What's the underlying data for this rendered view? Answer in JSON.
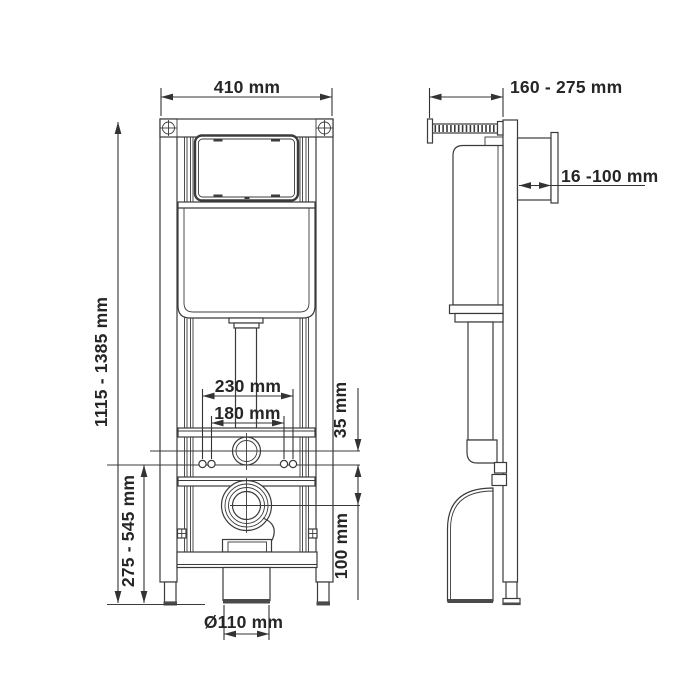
{
  "drawing": {
    "background": "#ffffff",
    "line_color": "#3b3b3b",
    "text_color": "#262626",
    "dims": {
      "frame_width": "410 mm",
      "frame_height": "1115 - 1385 mm",
      "depth_range": "160 - 275 mm",
      "wall_finish_range": "16 -100 mm",
      "fixing_outer": "230 mm",
      "fixing_inner": "180 mm",
      "inlet_offset": "35 mm",
      "outlet_offset": "100 mm",
      "outlet_height_range": "275 - 545 mm",
      "waste_diameter": "Ø110 mm"
    }
  }
}
